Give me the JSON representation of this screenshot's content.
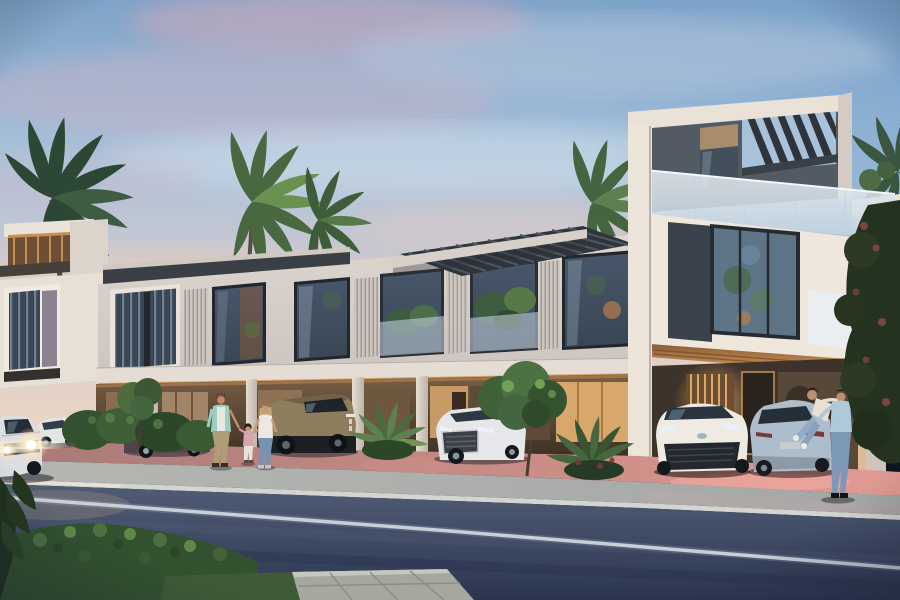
{
  "scene": {
    "type": "architectural-render",
    "description": "Dusk exterior rendering of a modern white townhouse complex with rooftop pergolas, glass balconies, covered street-level parking, palm trees, parked SUVs, a family walking on the sidewalk and a couple by the entrance",
    "time_of_day": "dusk",
    "weather": "partly cloudy"
  },
  "colors": {
    "sky_top": "#7FA3C9",
    "sky_mid": "#A9C3DC",
    "sky_low": "#D6C9CB",
    "sky_horizon": "#E9D6C4",
    "cloud_pink": "#CBAEBE",
    "facade_light": "#EBE3D8",
    "facade_shade": "#CEC7C2",
    "roof_dark": "#3A3F46",
    "warm_light": "#D99C5C",
    "window_glass": "#3A4654",
    "glass_rail": "#DCE7EF",
    "road_top": "#515D76",
    "road_bottom": "#2B3550",
    "lane_line": "#C7D0DB",
    "sidewalk": "#B5B6B1",
    "paving_pink": "#E29B93",
    "hedge_green": "#3A5833",
    "palm_green": "#47663F",
    "tree_dark": "#243220",
    "car_white": "#E6E7E8",
    "hummer_sand": "#8E7E5E",
    "bmw_silver": "#AEBDCB",
    "denim_blue": "#7E98B8"
  },
  "buildings": [
    {
      "name": "left-terrace-block",
      "storeys": 2,
      "features": [
        "rooftop pergola with warm lighting",
        "dark framed picture window"
      ]
    },
    {
      "name": "main-townhouse-block",
      "storeys": 2,
      "features": [
        "floor-to-ceiling windows",
        "vertical louver screens",
        "planted balconies",
        "slatted roof canopy",
        "ground-floor carports with columns"
      ]
    },
    {
      "name": "corner-tower",
      "storeys": 3,
      "features": [
        "rooftop slatted pergola",
        "frosted glass balcony",
        "dark accent wall",
        "warm lit soffit",
        "entrance lobby"
      ]
    }
  ],
  "vehicles": [
    {
      "name": "moving-car",
      "color": "white",
      "state": "driving with headlights on, left foreground"
    },
    {
      "name": "audi-q7-suv",
      "color": "white",
      "state": "parked, far left"
    },
    {
      "name": "dark-suv",
      "color": "graphite",
      "state": "parked behind shrubs"
    },
    {
      "name": "hummer-ev-suv",
      "color": "sand",
      "state": "parked in carport"
    },
    {
      "name": "audi-q8-suv",
      "color": "white",
      "state": "parked in carport, center-right"
    },
    {
      "name": "toyota-chr",
      "color": "white",
      "state": "parked under tower"
    },
    {
      "name": "bmw-hatchback",
      "color": "silver-blue",
      "state": "parked under tower, rear view"
    }
  ],
  "people": [
    {
      "name": "man-walking",
      "clothing": "mint shirt over white tee, khaki trousers"
    },
    {
      "name": "child-walking",
      "clothing": "pink top, white trousers"
    },
    {
      "name": "woman-walking",
      "clothing": "white top, blue jeans"
    },
    {
      "name": "man-at-entrance",
      "clothing": "light blue shirt, blue jeans, lifting woman"
    },
    {
      "name": "woman-lifted",
      "clothing": "cream top, light jeans, white shoes"
    }
  ],
  "vegetation": [
    "palm trees",
    "clipped shrubs",
    "ornamental trees",
    "foreground hedge",
    "fan palms",
    "dark flowering tree at right"
  ],
  "street": {
    "elements": [
      "asphalt road",
      "white lane line",
      "concrete sidewalk",
      "rose paved driveway apron",
      "stone paver walkway",
      "grass verge"
    ]
  }
}
